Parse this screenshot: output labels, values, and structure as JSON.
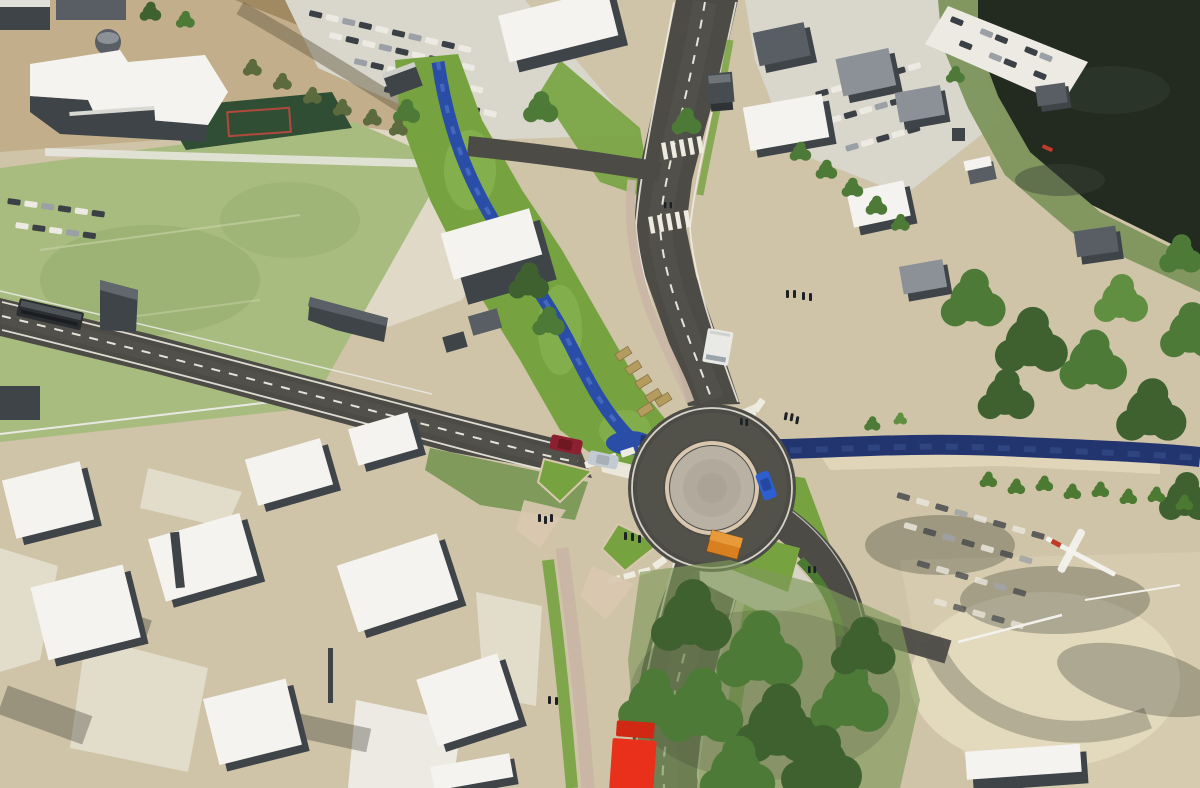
{
  "meta": {
    "description": "Aerial 3D architectural rendering of a planned roundabout where a main street meets a side road, with a daylighted stream flowing into an east-west river, sports fields and a school at upper left, parking lots and grey block buildings, a dark lake with a marina at upper right, tree groves and a sandy lot at lower right.",
    "text_on_screen": "none"
  },
  "palette": {
    "asphalt": "#4c4b46",
    "asphalt-worn": "#5a5850",
    "road-mark": "#eeebe0",
    "sidewalk": "#c9b6a5",
    "paver": "#b9b2a4",
    "concrete": "#d9d4c7",
    "kerb": "#d9c8af",
    "grass": "#76a33f",
    "grass-light": "#8cb957",
    "grass-muted": "#7f9a5a",
    "hedge": "#4d7a33",
    "tree-dark": "#3f6130",
    "tree-mid": "#4e7a38",
    "tree-light": "#618f41",
    "scrub": "#5c6b3d",
    "field": "#a9bc80",
    "field-dark": "#8fa969",
    "court": "#2f4e34",
    "court-line": "#b14a3c",
    "stream": "#2a4da8",
    "stream-light": "#4a6fc0",
    "river": "#23356e",
    "lake": "#232a20",
    "shore": "#7d955c",
    "terrain": "#cfc3a8",
    "terrain-tan": "#c2ae8a",
    "terrain-brown": "#9b8359",
    "terrain-light": "#e2dccb",
    "pavement": "#d9d6cc",
    "pavement-bright": "#eceae2",
    "sand": "#d6cbae",
    "sand-light": "#e3d9bd",
    "roof-white": "#f4f3ef",
    "wall-dark": "#3f4449",
    "wall-grey": "#585e63",
    "wall-light": "#8b9196",
    "fence": "#e9e8e2",
    "shadow": "rgba(30,38,25,0.30)",
    "car-dark": "#3b4046",
    "car-white": "#eceae2",
    "car-grey": "#9aa0a6",
    "bus-dark": "#2b2e30",
    "truck-red": "#e8301a",
    "car-red": "#8c2030",
    "car-blue": "#2e5fd0",
    "car-silver": "#c3cad1",
    "van-white": "#e9eae6",
    "shelter-orange": "#d8801f",
    "gabion": "#b49b5e",
    "glider-white": "#f2f1ec",
    "glider-red": "#c03a2a"
  },
  "vehicles": [
    {
      "id": "bus-west-road",
      "color_key": "bus-dark"
    },
    {
      "id": "box-truck-north-road",
      "color_key": "car-dark"
    },
    {
      "id": "white-van-north-road",
      "color_key": "van-white"
    },
    {
      "id": "red-car-west-approach",
      "color_key": "car-red"
    },
    {
      "id": "silver-car-west-approach",
      "color_key": "car-silver"
    },
    {
      "id": "blue-car-roundabout-exit",
      "color_key": "car-blue"
    },
    {
      "id": "red-truck-south-road",
      "color_key": "truck-red"
    }
  ],
  "features": [
    "roundabout-with-paved-centre-island",
    "main-street-north-south",
    "side-road-west",
    "southeast-access-road-with-lane-arrow",
    "zebra-crossings-and-block-crossings",
    "splitter-islands",
    "daylighted-stream-with-green-banks",
    "east-west-river-under-road-bridge",
    "gabion-stone-walls",
    "orange-bus-shelter",
    "sports-field-and-dark-green-court",
    "school-building-white-roof",
    "grey-block-buildings-white-roofs",
    "parking-lots-with-parked-cars",
    "lake-with-marina-and-red-boat",
    "tree-groves",
    "sandy-lot-bottom-right",
    "white-glider-on-ground",
    "pedestrian-groups"
  ]
}
